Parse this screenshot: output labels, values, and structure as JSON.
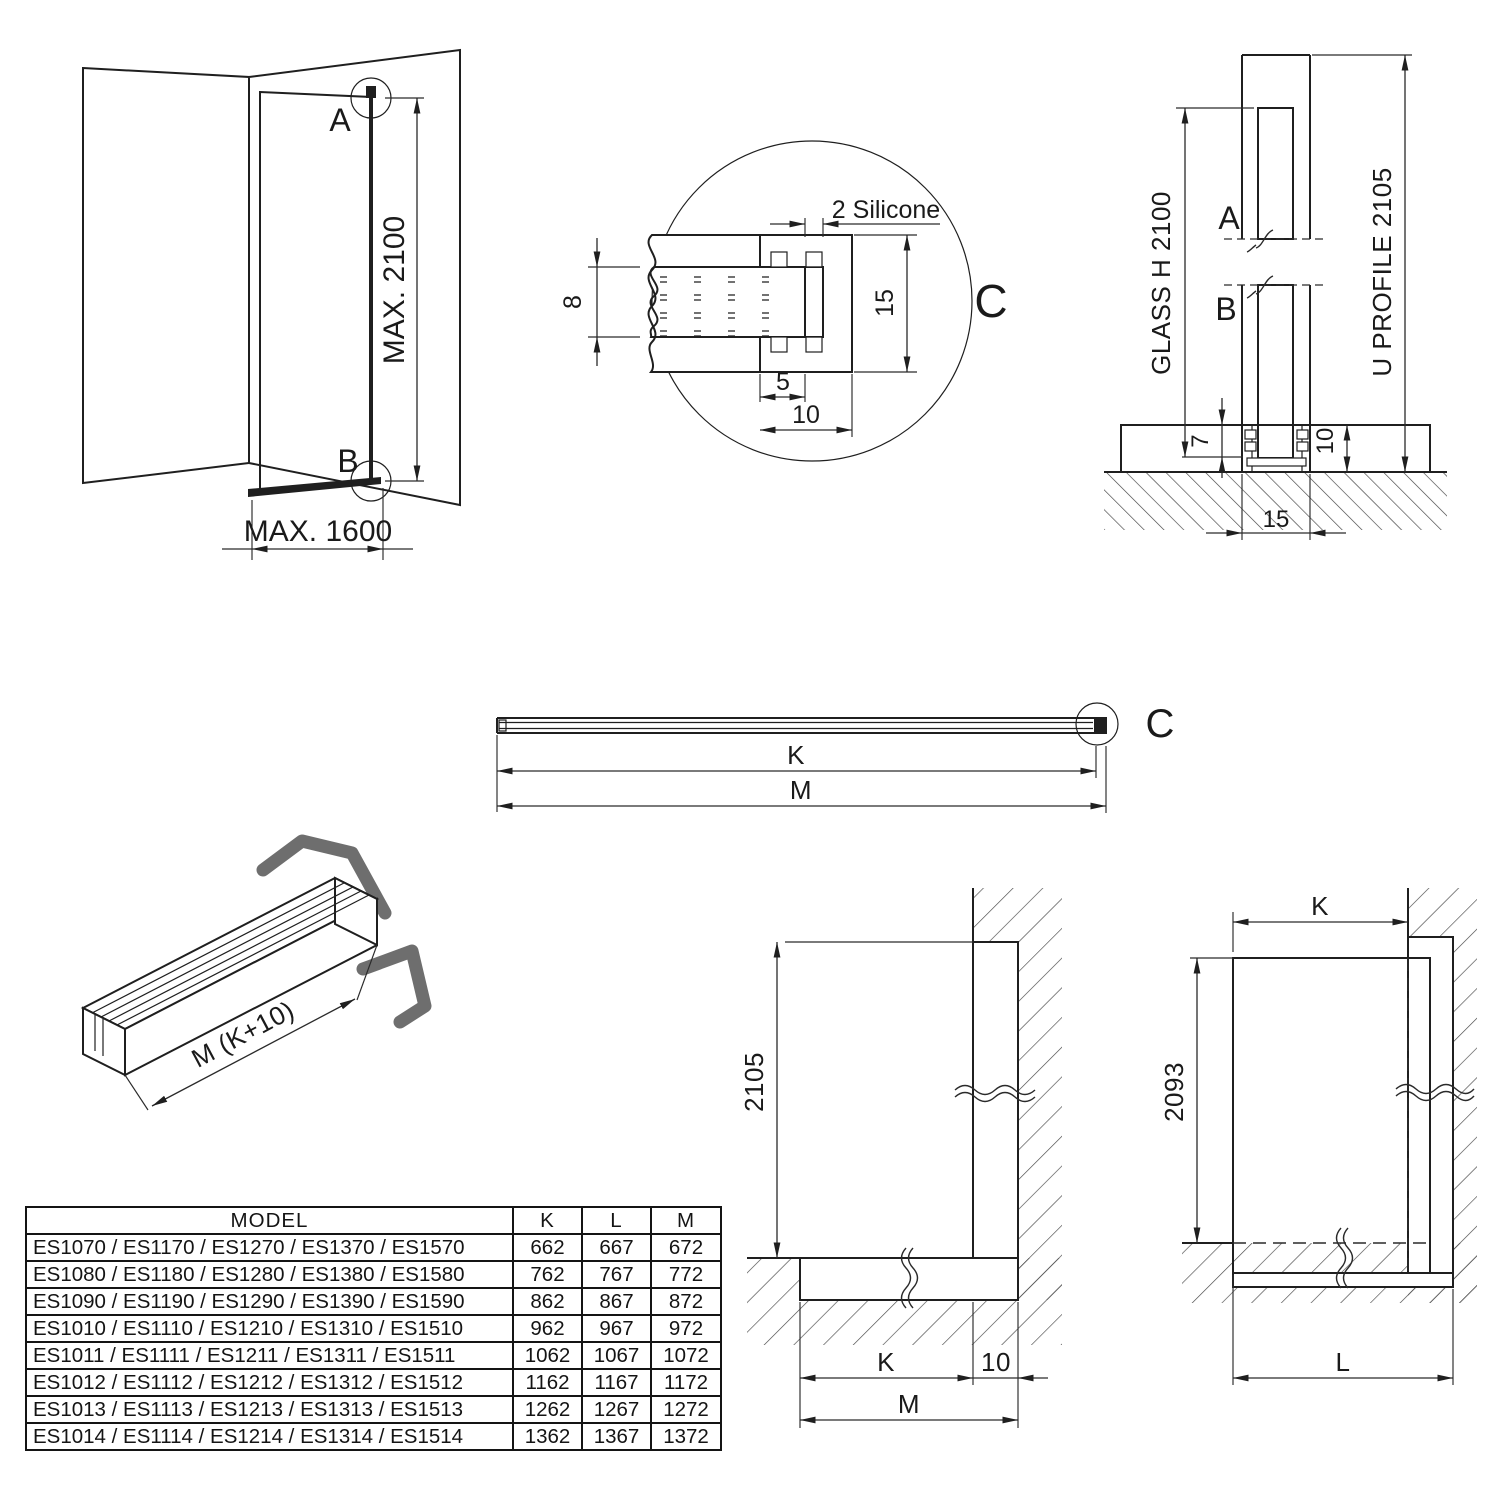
{
  "drawing": {
    "glass_color": "#d6fcfc",
    "line_color": "#1f1f1f",
    "labels": {
      "a": "A",
      "b": "B",
      "c": "C",
      "k": "K",
      "l": "L",
      "m": "M",
      "max_h": "MAX. 2100",
      "max_w": "MAX. 1600",
      "silicone": "2 Silicone",
      "d8": "8",
      "d5": "5",
      "d10": "10",
      "d15": "15",
      "d7": "7",
      "glass_h": "GLASS H 2100",
      "u_profile": "U PROFILE 2105",
      "d2105": "2105",
      "d2093": "2093",
      "profile_len": "M (K+10)"
    }
  },
  "table": {
    "headers": {
      "model": "MODEL",
      "k": "K",
      "l": "L",
      "m": "M"
    },
    "rows": [
      {
        "model": "ES1070 / ES1170 / ES1270 / ES1370 / ES1570",
        "k": "662",
        "l": "667",
        "m": "672"
      },
      {
        "model": "ES1080 / ES1180 / ES1280 / ES1380 / ES1580",
        "k": "762",
        "l": "767",
        "m": "772"
      },
      {
        "model": "ES1090 / ES1190 / ES1290 / ES1390 / ES1590",
        "k": "862",
        "l": "867",
        "m": "872"
      },
      {
        "model": "ES1010 / ES1110 / ES1210 / ES1310 / ES1510",
        "k": "962",
        "l": "967",
        "m": "972"
      },
      {
        "model": "ES1011 / ES1111 / ES1211 / ES1311 / ES1511",
        "k": "1062",
        "l": "1067",
        "m": "1072"
      },
      {
        "model": "ES1012 / ES1112 / ES1212 / ES1312 / ES1512",
        "k": "1162",
        "l": "1167",
        "m": "1172"
      },
      {
        "model": "ES1013 / ES1113 / ES1213 / ES1313 / ES1513",
        "k": "1262",
        "l": "1267",
        "m": "1272"
      },
      {
        "model": "ES1014 / ES1114 / ES1214 / ES1314 / ES1514",
        "k": "1362",
        "l": "1367",
        "m": "1372"
      }
    ]
  }
}
